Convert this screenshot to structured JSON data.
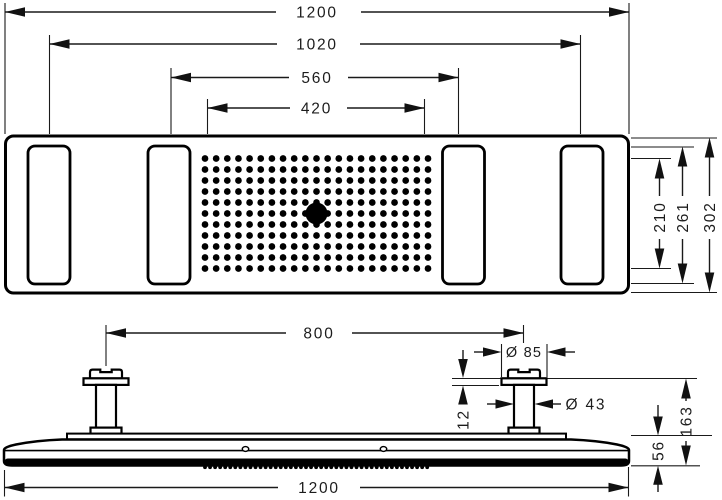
{
  "drawing": {
    "top_view": {
      "dims": {
        "overall_width": "1200",
        "outer_jet_spacing": "1020",
        "inner_jet_spacing": "560",
        "spray_field_width": "420",
        "spray_field_height": "210",
        "jet_slot_height": "261",
        "overall_depth": "302"
      },
      "spray_grid": {
        "cols": 21,
        "rows": 11,
        "x0": 205,
        "y0": 158.5,
        "dx": 11.15,
        "dy": 11,
        "dot_r": 3.35,
        "center_col": 10,
        "center_row": 5,
        "center_r": 11
      }
    },
    "side_view": {
      "dims": {
        "connector_spacing": "800",
        "flange_diameter": "Ø 85",
        "pipe_diameter": "Ø 43",
        "flange_height": "12",
        "total_height": "163",
        "body_height": "56",
        "overall_width": "1200"
      },
      "nozzle_row": {
        "count": 45,
        "x0": 205,
        "dx": 5.05,
        "y": 467.2,
        "r": 1.9
      }
    },
    "colors": {
      "line": "#000000",
      "background": "#ffffff"
    }
  }
}
